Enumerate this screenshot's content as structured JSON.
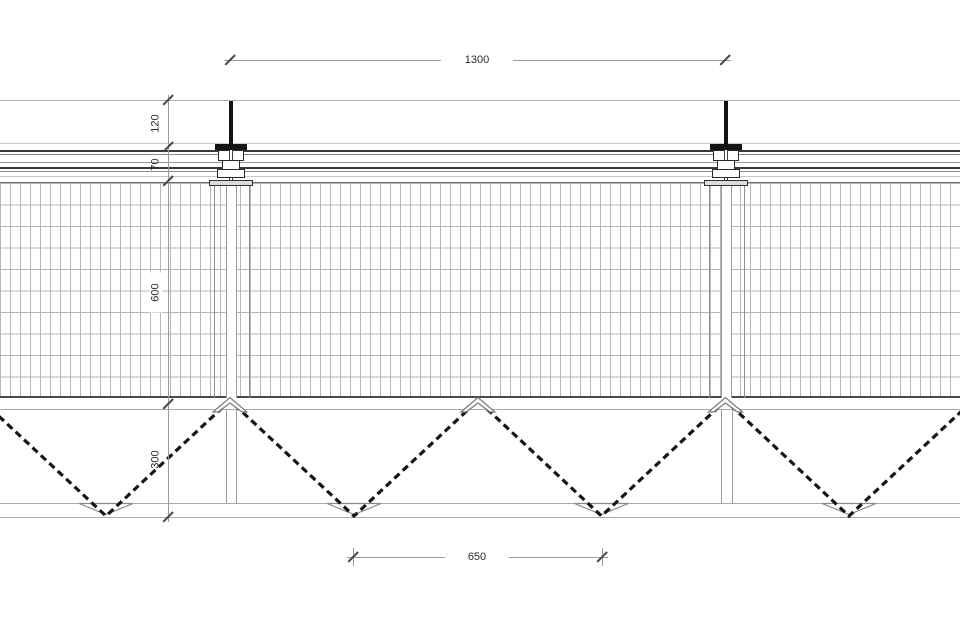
{
  "drawing": {
    "kind": "construction-section-detail",
    "description": "Suspended ceiling / panel section with hanger rods, furring profiles, hatched panel and zig-zag truss web",
    "background": "#ffffff"
  },
  "dims": {
    "top": {
      "label": "1300"
    },
    "left": [
      {
        "label": "120"
      },
      {
        "label": "70"
      },
      {
        "label": "600"
      },
      {
        "label": "300"
      }
    ],
    "bottom": {
      "label": "650"
    }
  },
  "colors": {
    "ink": "#141414",
    "dark_line": "#3a3a3a",
    "medium_line": "#8a8a8a",
    "light_line": "#c6c6c6",
    "grid_line": "#b6b6b6",
    "dim_line": "#9a9a9a",
    "text": "#2b2b2b",
    "background": "#ffffff"
  }
}
